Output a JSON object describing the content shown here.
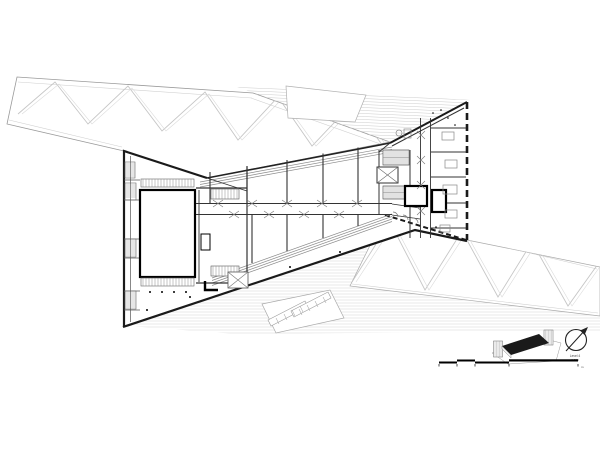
{
  "legend": {
    "north_caption_line1": "Level 4",
    "north_caption_line2": "1:500",
    "scale_unit_label": "m"
  },
  "colors": {
    "background": "#ffffff",
    "ink": "#1a1a1a",
    "wall": "#333333",
    "roof_line": "#c6c6c6",
    "hatch_line": "#d2d2d2",
    "axon_roof": "#1a1a1a"
  }
}
